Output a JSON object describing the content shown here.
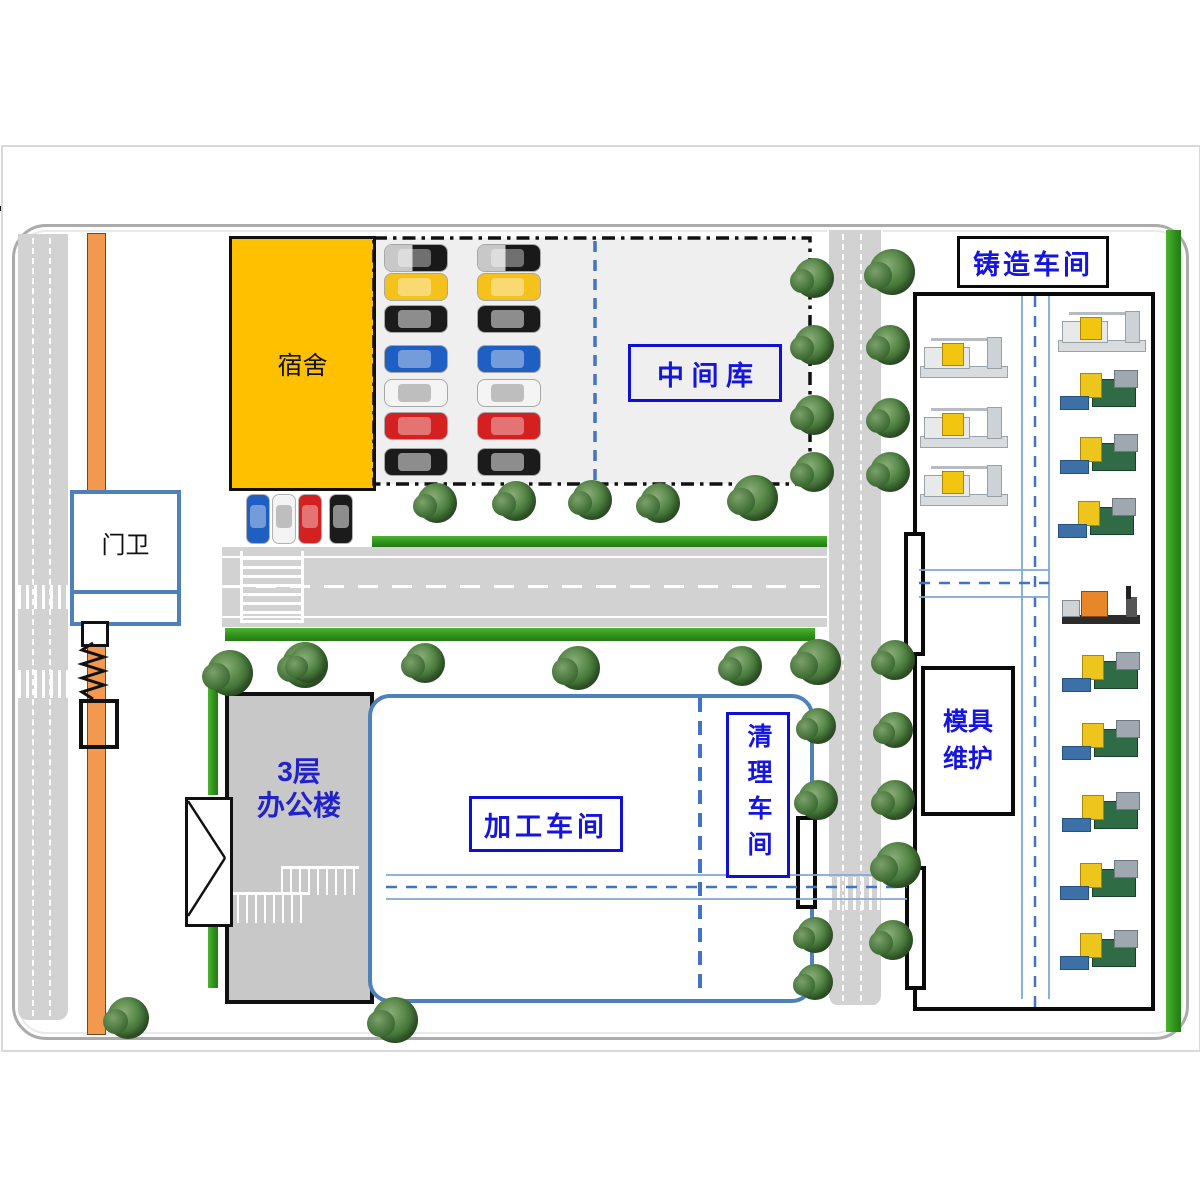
{
  "header": {
    "left_tab": "公司概况",
    "title": "公司平面布置图",
    "company": "南京天翔机电有限公司"
  },
  "labels": {
    "dormitory": "宿舍",
    "gatehouse": "门卫",
    "warehouse": "中 间 库",
    "casting": "铸造车间",
    "processing": "加工车间",
    "cleaning": "清理车间",
    "mold_l1": "模具",
    "mold_l2": "维护",
    "office_l1": "3层",
    "office_l2": "办公楼"
  },
  "colors": {
    "accent_blue_border": "#4E81BC",
    "label_blue_text": "#1515DF",
    "label_blue_border": "#0f0fd6",
    "dormitory_yellow": "#FFC000",
    "fence_orange": "#F2994F",
    "road_gray": "#d2d2d2",
    "grass_green": "#2f8f1d",
    "parking_gray": "#EFEFEF",
    "aisle_blue": "#7FA8D9",
    "aisle_dash_blue": "#4472C4"
  },
  "trees": [
    [
      437,
      503
    ],
    [
      516,
      501
    ],
    [
      592,
      500
    ],
    [
      660,
      503
    ],
    [
      755,
      498,
      46
    ],
    [
      814,
      278
    ],
    [
      814,
      345
    ],
    [
      814,
      415
    ],
    [
      814,
      472
    ],
    [
      892,
      272,
      46
    ],
    [
      890,
      345
    ],
    [
      890,
      418
    ],
    [
      890,
      472
    ],
    [
      818,
      662,
      46
    ],
    [
      818,
      726,
      36
    ],
    [
      818,
      800
    ],
    [
      815,
      935,
      36
    ],
    [
      815,
      982,
      36
    ],
    [
      895,
      660
    ],
    [
      895,
      730,
      36
    ],
    [
      895,
      800
    ],
    [
      898,
      865,
      46
    ],
    [
      893,
      940
    ],
    [
      305,
      665,
      46
    ],
    [
      425,
      663
    ],
    [
      578,
      668,
      44
    ],
    [
      742,
      666
    ],
    [
      230,
      673,
      46
    ],
    [
      308,
      664,
      38
    ],
    [
      128,
      1018,
      42
    ],
    [
      395,
      1020,
      46
    ]
  ],
  "parking": {
    "column_x": [
      385,
      478
    ],
    "rows": [
      {
        "y": 245,
        "color": "suv"
      },
      {
        "y": 274,
        "color": "yellow"
      },
      {
        "y": 306,
        "color": "black"
      },
      {
        "y": 346,
        "color": "blue"
      },
      {
        "y": 380,
        "color": "white"
      },
      {
        "y": 413,
        "color": "red"
      },
      {
        "y": 449,
        "color": "black"
      }
    ]
  },
  "street_cars": {
    "y": 495,
    "cars": [
      {
        "x": 247,
        "color": "blue"
      },
      {
        "x": 273,
        "color": "white"
      },
      {
        "x": 299,
        "color": "red"
      },
      {
        "x": 330,
        "color": "black"
      }
    ]
  },
  "machines": {
    "white": [
      [
        920,
        336
      ],
      [
        920,
        406
      ],
      [
        920,
        464
      ],
      [
        1058,
        310
      ]
    ],
    "green": [
      [
        1060,
        370
      ],
      [
        1060,
        434
      ],
      [
        1058,
        498
      ],
      [
        1062,
        652
      ],
      [
        1062,
        720
      ],
      [
        1062,
        792
      ],
      [
        1060,
        860
      ],
      [
        1060,
        930
      ]
    ],
    "orange": [
      [
        1060,
        586
      ]
    ]
  }
}
